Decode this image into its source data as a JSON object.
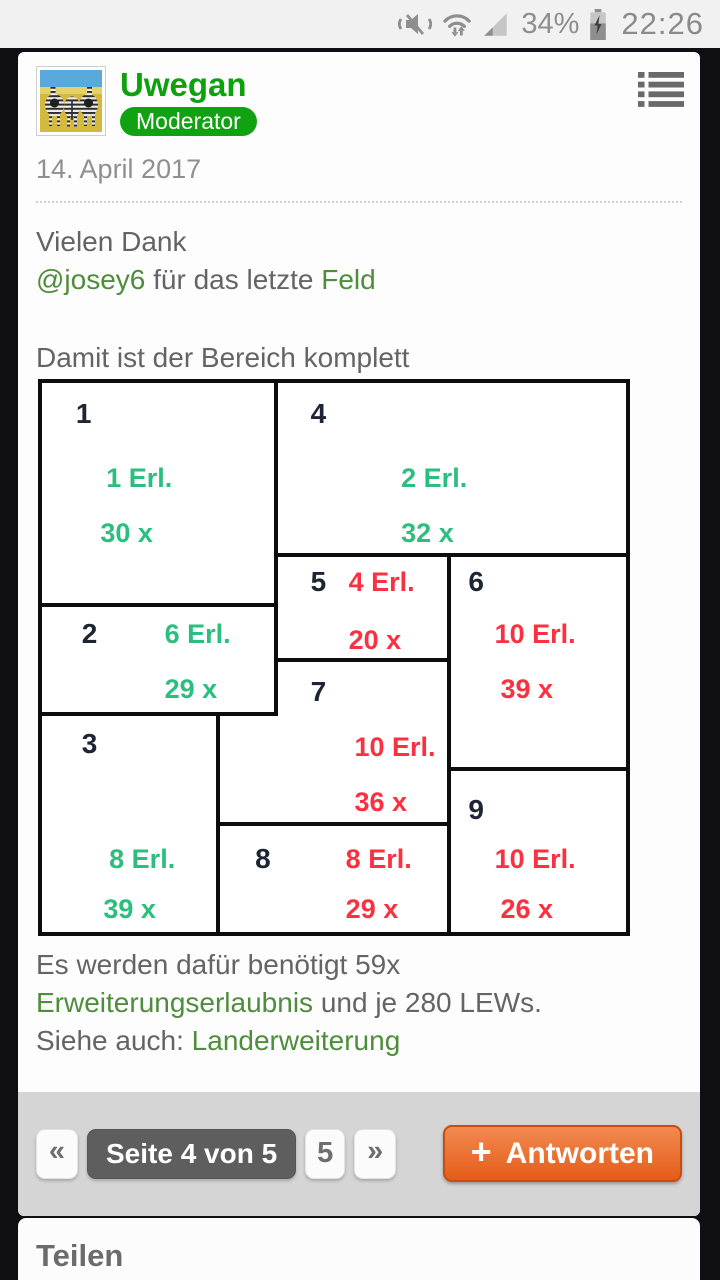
{
  "status_bar": {
    "battery_percent": "34%",
    "time": "22:26"
  },
  "post": {
    "author": "Uwegan",
    "badge": "Moderator",
    "date": "14. April 2017",
    "para1_line1": "Vielen Dank",
    "para1_mention": "@josey6",
    "para1_mid": " für das letzte ",
    "para1_link": "Feld",
    "para2": "Damit ist der Bereich komplett",
    "para3_pre": "Es werden dafür benötigt 59x ",
    "para3_link": "Erweiterungserlaubnis",
    "para3_post": " und je 280 LEWs.",
    "para4_pre": "Siehe auch: ",
    "para4_link": "Landerweiterung"
  },
  "diagram": {
    "fields": [
      {
        "number": "1",
        "erl": "1 Erl.",
        "count": "30 x",
        "status": "complete"
      },
      {
        "number": "2",
        "erl": "6 Erl.",
        "count": "29 x",
        "status": "complete"
      },
      {
        "number": "3",
        "erl": "8 Erl.",
        "count": "39 x",
        "status": "complete"
      },
      {
        "number": "4",
        "erl": "2 Erl.",
        "count": "32 x",
        "status": "complete"
      },
      {
        "number": "5",
        "erl": "4 Erl.",
        "count": "20 x",
        "status": "open"
      },
      {
        "number": "6",
        "erl": "10 Erl.",
        "count": "39 x",
        "status": "open"
      },
      {
        "number": "7",
        "erl": "10 Erl.",
        "count": "36 x",
        "status": "open"
      },
      {
        "number": "8",
        "erl": "8 Erl.",
        "count": "29 x",
        "status": "open"
      },
      {
        "number": "9",
        "erl": "10 Erl.",
        "count": "26 x",
        "status": "open"
      }
    ],
    "colors": {
      "complete_green": "#2abf7e",
      "open_red": "#fb3040",
      "number": "#1d2433"
    }
  },
  "pagination": {
    "first_label": "«",
    "current_label": "Seite 4 von 5",
    "page_label": "5",
    "last_label": "»"
  },
  "reply_button": {
    "plus": "+",
    "label": "Antworten",
    "color": "#e45c17"
  },
  "share": {
    "title": "Teilen"
  },
  "ui_colors": {
    "username_green": "#0da10d",
    "badge_green": "#11a211",
    "link_green": "#4e8d3b",
    "footer_gray": "#d5d5d5"
  },
  "icons": {
    "status": [
      "vibrate-muted",
      "wifi",
      "cell-signal",
      "battery-charging"
    ],
    "header": "list-menu"
  }
}
